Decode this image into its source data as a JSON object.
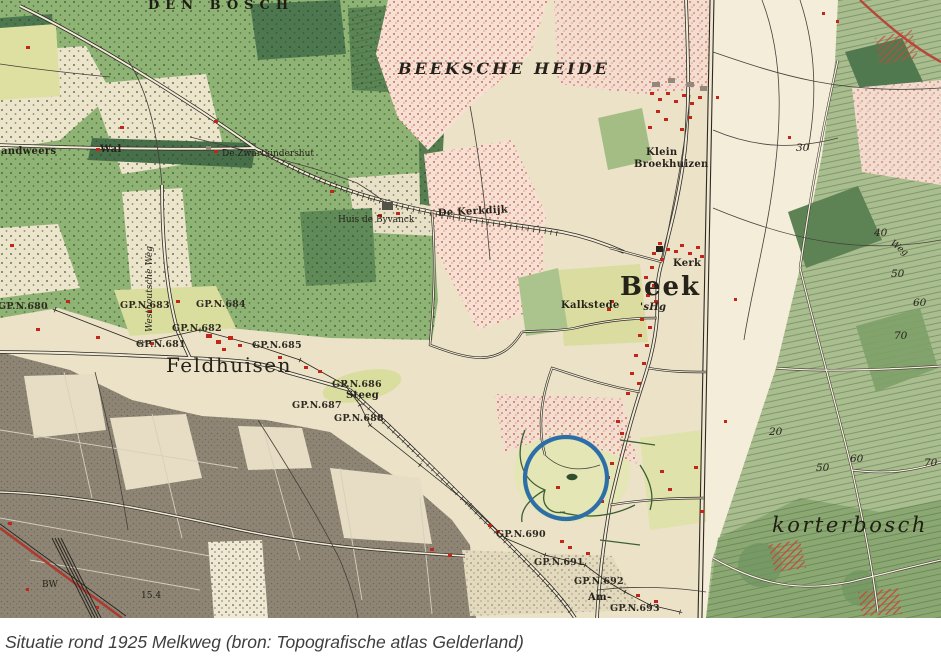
{
  "caption": {
    "text": "Situatie rond 1925 Melkweg (bron: Topografische atlas Gelderland)"
  },
  "map": {
    "place_labels": {
      "den_bosch": "DEN BOSCH",
      "beeksche_heide": "BEEKSCHE  HEIDE",
      "beek": "Beek",
      "kerk": "Kerk",
      "s_heerenberg_abbrev": "'sHg",
      "kalkstede": "Kalkstede",
      "klein": "Klein",
      "broekhuizen": "Broekhuizen",
      "feldhuisen": "Feldhuisen",
      "steeg": "Steeg",
      "de_kerkdijk": "De Kerkdijk",
      "huis_de_byvanck": "Huis de Byvanck",
      "zwartkindershut": "De Zwartkindershut",
      "wal": "Wal",
      "landweers": "andweers",
      "westhoutsche_weg": "Westhoutsche Weg",
      "korterbosch": "korterbosch",
      "weg": "Weg",
      "am": "Am-",
      "bw": "BW",
      "spot_height": "15.4"
    },
    "border_markers": {
      "gp680": "GP.N.680",
      "gp681": "GP.N.681",
      "gp682": "GP.N.682",
      "gp683": "GP.N.683",
      "gp684": "GP.N.684",
      "gp685": "GP.N.685",
      "gp686": "GP.N.686",
      "gp687": "GP.N.687",
      "gp688": "GP.N.688",
      "gp690": "GP.N.690",
      "gp691": "GP.N.691",
      "gp692": "GP.N.692",
      "gp693": "GP.N.693"
    },
    "elevations": {
      "h20": "20",
      "h30": "30",
      "h40": "40",
      "h50": "50",
      "h60": "60",
      "h70": "70"
    },
    "annotation_circle": {
      "color": "#2d6ea6"
    },
    "palette": {
      "paper_cream": "#ebe2c8",
      "woods_green": "#8fb375",
      "heath_red": "#cf4a36",
      "building_red": "#c1261a",
      "urban_gray": "#8e8575"
    }
  }
}
